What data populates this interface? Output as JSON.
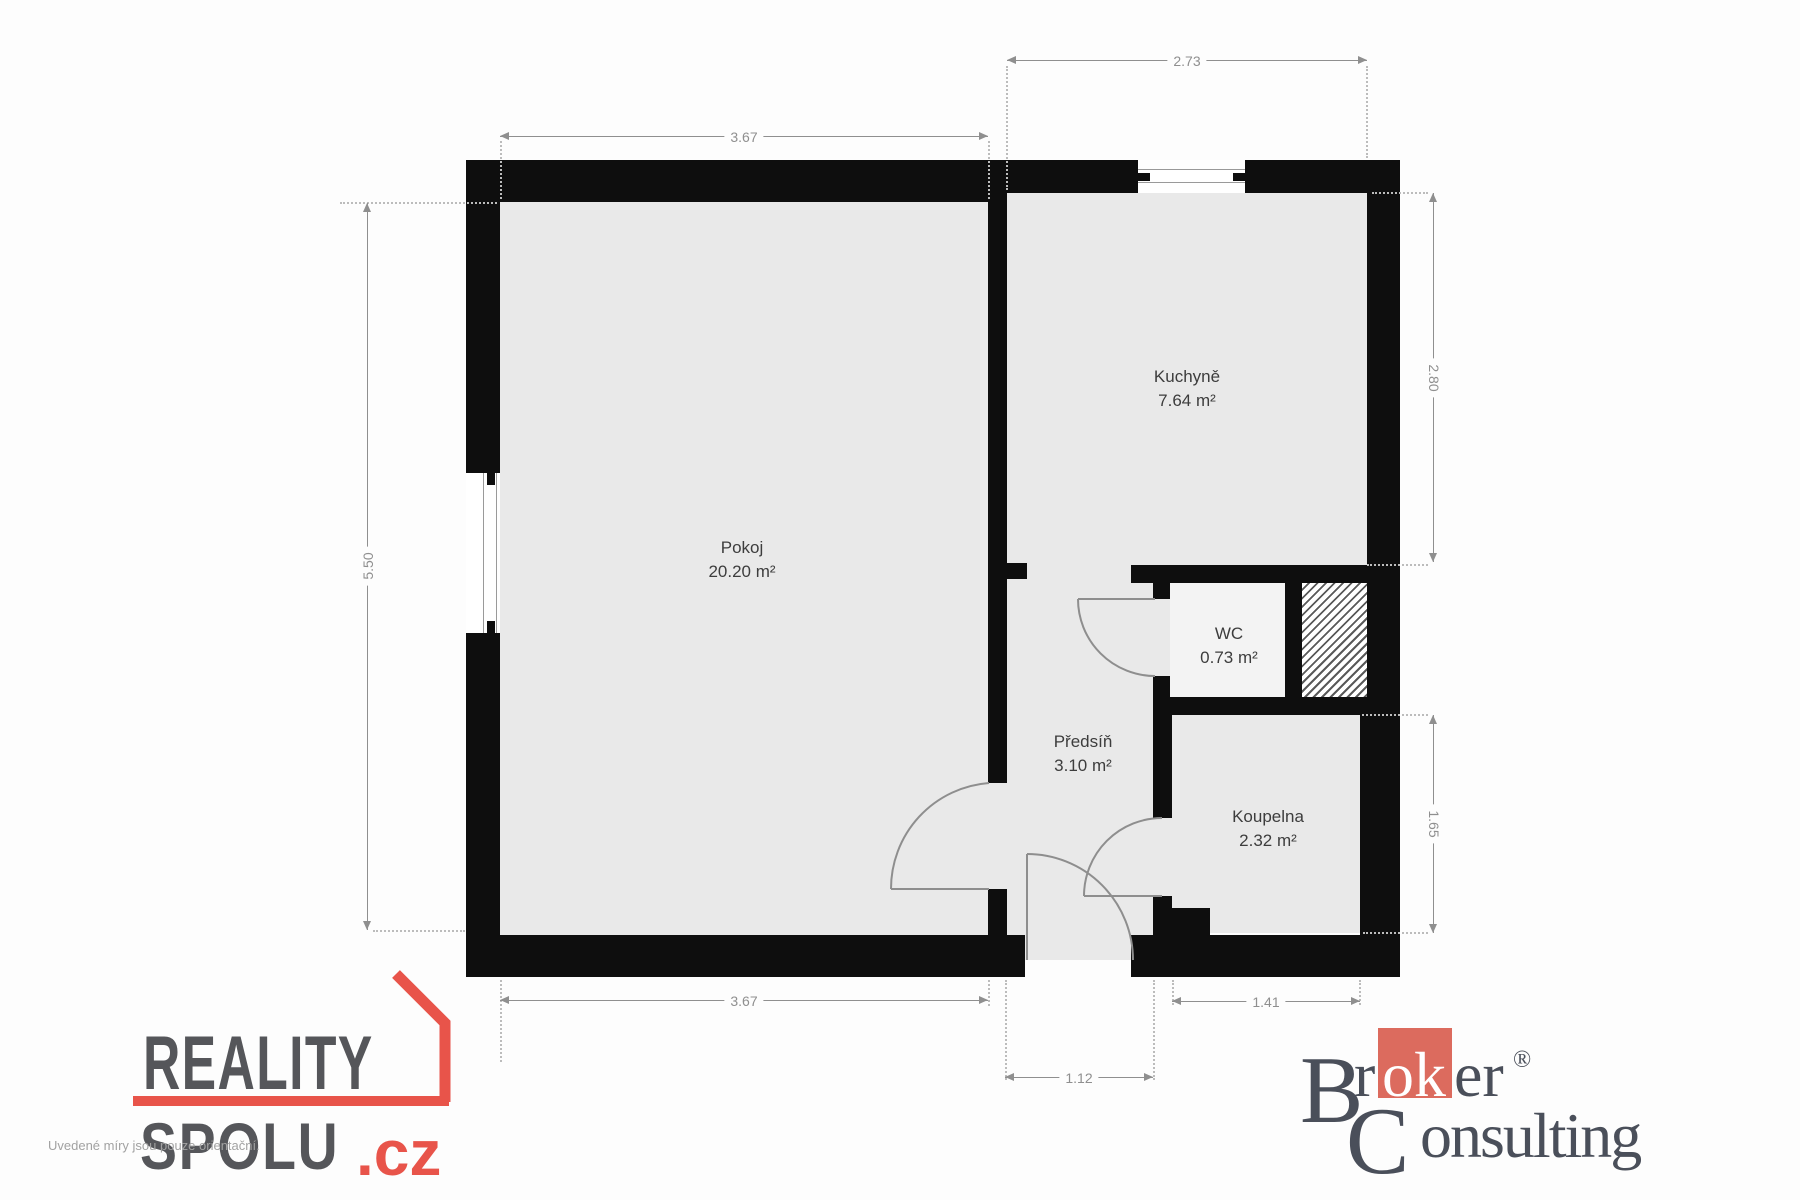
{
  "colors": {
    "wall": "#0e0e0e",
    "floor": "#e9e9e9",
    "dim_line": "#8f8f8f",
    "dim_text": "#8f8f8f",
    "leader_dotted": "#bcbcbc",
    "room_text": "#3d3d3d",
    "door_arc": "#8e8e8e",
    "window_line": "#9a9a9a",
    "reality_red": "#e8544a",
    "reality_gray": "#55565a",
    "broker_red": "#dc6b5e",
    "broker_gray": "#4a4f5a",
    "disclaimer_gray": "#a2a2a2"
  },
  "rooms": {
    "pokoj": {
      "name": "Pokoj",
      "area": "20.20 m²"
    },
    "kuchyne": {
      "name": "Kuchyně",
      "area": "7.64 m²"
    },
    "wc": {
      "name": "WC",
      "area": "0.73 m²"
    },
    "predsin": {
      "name": "Předsíň",
      "area": "3.10 m²"
    },
    "koupelna": {
      "name": "Koupelna",
      "area": "2.32 m²"
    }
  },
  "dimensions": {
    "kitchen_width_top": "2.73",
    "room_width_top": "3.67",
    "room_height_left": "5.50",
    "kitchen_height_right": "2.80",
    "bathroom_height_right": "1.65",
    "room_width_bottom": "3.67",
    "entry_width_bottom": "1.12",
    "bathroom_width_bottom": "1.41"
  },
  "branding": {
    "reality_spolu": {
      "word1": "REALITY",
      "word2": "SPOLU",
      "tld": ".cz"
    },
    "disclaimer": "Uvedené míry jsou pouze orientační.",
    "broker_consulting": {
      "cap_b": "B",
      "r": "r",
      "ok": "ok",
      "er": "er",
      "registered": "®",
      "cap_c": "C",
      "onsulting": "onsulting"
    }
  }
}
